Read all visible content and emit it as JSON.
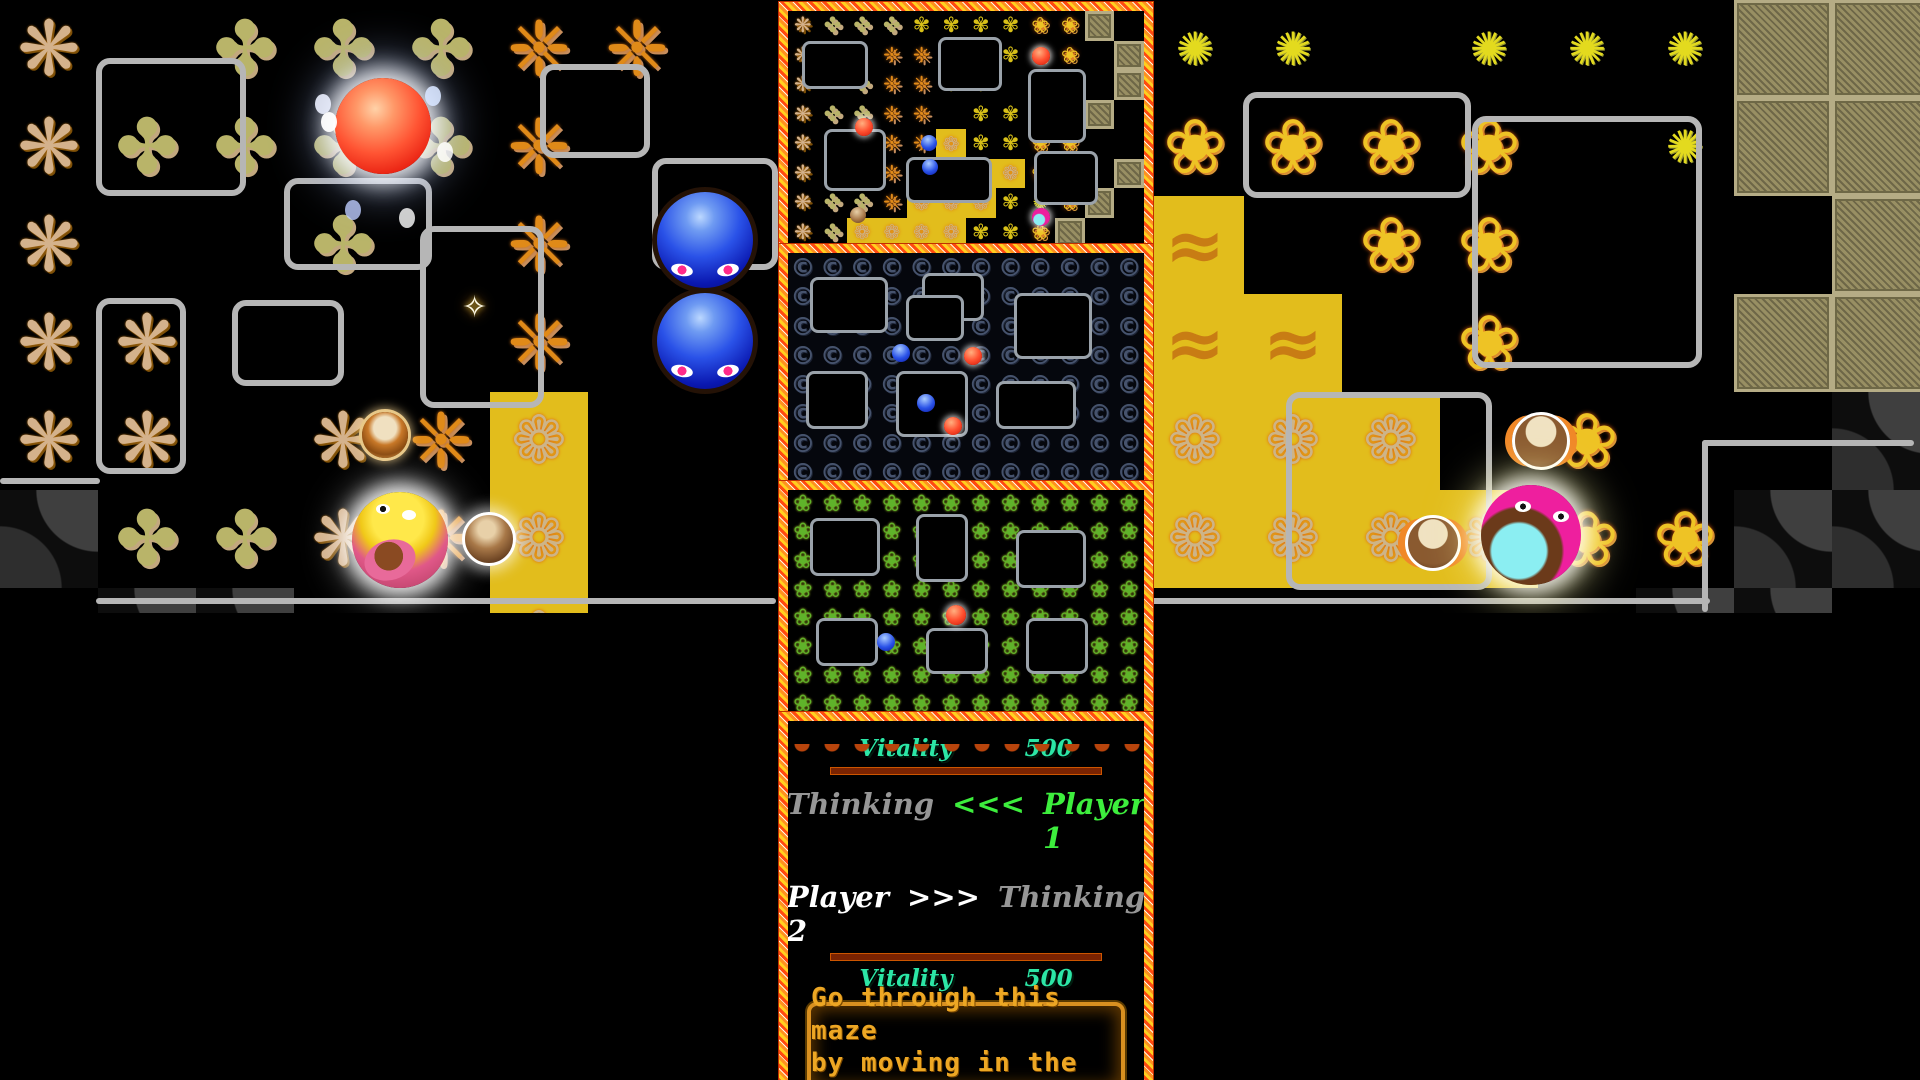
{
  "hud": {
    "player1": {
      "vitality_label": "Vitality",
      "vitality_value": "500",
      "vitality_percent": 50,
      "status_label": "Thinking",
      "arrows": "<<<",
      "name_label": "Player 1"
    },
    "player2": {
      "name_label": "Player 2",
      "arrows": ">>>",
      "status_label": "Thinking",
      "vitality_label": "Vitality",
      "vitality_value": "500",
      "vitality_percent": 50
    },
    "message_lines": [
      "Go through this maze",
      "by moving in the four"
    ],
    "colors": {
      "vitality_text": "#2ce6a6",
      "active_green": "#3dee3d",
      "idle_gray": "#969696",
      "p2_white": "#ffffff",
      "bar_fill_start": "#7ae22a",
      "bar_fill_end": "#e8a428",
      "bar_empty": "#8d7d5b",
      "bar_border": "#7a2301",
      "divider_cyan": "#18d2f4",
      "message_text": "#eda724",
      "wall_gray": "#b6b6b6"
    }
  },
  "tile_legend": {
    "star": {
      "glyph": "❋",
      "desc": "tan eight-point star tile"
    },
    "leaf": {
      "glyph": "✤",
      "desc": "olive leaf-cluster tile"
    },
    "ornate": {
      "glyph": "❈",
      "desc": "orange ornate snowflake tile"
    },
    "gold": {
      "glyph": "❁",
      "desc": "gold gear tile on yellow"
    },
    "swirl": {
      "glyph": "≈",
      "desc": "gold swirl tile on yellow"
    },
    "flower": {
      "glyph": "❀",
      "desc": "golden pentagon flower tile"
    },
    "pin": {
      "glyph": "✺",
      "desc": "small yellow pinwheel tile"
    },
    "golddot": {
      "glyph": "✾",
      "desc": "small gold flower tile"
    },
    "khaki": {
      "glyph": "",
      "desc": "khaki textured block"
    },
    "deco": {
      "glyph": "",
      "desc": "dark gray quarter-circle tile"
    },
    "ctile": {
      "glyph": "©",
      "desc": "dark blue C tile"
    },
    "clover": {
      "glyph": "❀",
      "desc": "green clover tile"
    },
    "blank": {
      "glyph": "",
      "desc": "empty"
    }
  },
  "minimaps": [
    {
      "name": "minimap-overview",
      "rows": [
        "slllddddffk.",
        "sl.oo.ddff.k",
        "s.loodd.ff.k",
        "slloo.ddffk.",
        "sl.oogddff..",
        "s.loogggff.k",
        "sllogggdpfk.",
        "slggggddfk.."
      ],
      "walls": [
        [
          14,
          30,
          66,
          48
        ],
        [
          150,
          26,
          64,
          54
        ],
        [
          240,
          58,
          58,
          74
        ],
        [
          36,
          118,
          62,
          62
        ],
        [
          118,
          146,
          86,
          46
        ],
        [
          246,
          140,
          64,
          54
        ]
      ],
      "dots": [
        [
          "red",
          253,
          45,
          18
        ],
        [
          "red",
          76,
          116,
          18
        ],
        [
          "blue",
          141,
          132,
          16
        ],
        [
          "blue",
          142,
          156,
          16
        ],
        [
          "brown",
          70,
          204,
          16
        ],
        [
          "pink",
          253,
          206,
          18
        ]
      ]
    },
    {
      "name": "minimap-dark-c",
      "rows": [
        "cccccccccccc",
        "cccccccccccc",
        "cccccccccccc",
        "cccccccccccc",
        "cccccccccccc",
        "cccccccccccc",
        "cccccccccccc",
        "cccccccccccc"
      ],
      "walls": [
        [
          22,
          24,
          78,
          56
        ],
        [
          134,
          20,
          62,
          48
        ],
        [
          226,
          40,
          78,
          66
        ],
        [
          18,
          118,
          62,
          58
        ],
        [
          108,
          118,
          72,
          66
        ],
        [
          208,
          128,
          80,
          48
        ],
        [
          118,
          42,
          58,
          46
        ]
      ],
      "dots": [
        [
          "blue",
          113,
          100,
          18
        ],
        [
          "red",
          185,
          103,
          18
        ],
        [
          "blue",
          138,
          150,
          18
        ],
        [
          "red",
          165,
          173,
          18
        ]
      ]
    },
    {
      "name": "minimap-clover",
      "rows": [
        "vvvvvvvvvvvv",
        "vvvvvvvvvvvv",
        "vvvvvvvvvvvv",
        "vvvvvvvvvvvv",
        "vvvvvvvvvvvv",
        "vvvvvvvvvvvv",
        "vvvvvvvvvvvv",
        "vvvvvvvvvvvv"
      ],
      "walls": [
        [
          22,
          28,
          70,
          58
        ],
        [
          128,
          24,
          52,
          68
        ],
        [
          228,
          40,
          70,
          58
        ],
        [
          28,
          128,
          62,
          48
        ],
        [
          138,
          138,
          62,
          46
        ],
        [
          238,
          128,
          62,
          56
        ]
      ],
      "dots": [
        [
          "red",
          168,
          125,
          20
        ],
        [
          "blue",
          98,
          152,
          18
        ]
      ]
    }
  ],
  "mazes": {
    "left": {
      "tiles": [
        [
          "star",
          0,
          0
        ],
        [
          "star",
          0,
          1
        ],
        [
          "star",
          0,
          2
        ],
        [
          "star",
          0,
          3
        ],
        [
          "star",
          0,
          4
        ],
        [
          "star",
          1,
          3
        ],
        [
          "star",
          1,
          4
        ],
        [
          "star",
          3,
          4
        ],
        [
          "star",
          3,
          5
        ],
        [
          "leaf",
          2,
          0
        ],
        [
          "leaf",
          3,
          0
        ],
        [
          "leaf",
          4,
          0
        ],
        [
          "leaf",
          1,
          1
        ],
        [
          "leaf",
          2,
          1
        ],
        [
          "leaf",
          3,
          1
        ],
        [
          "leaf",
          4,
          1
        ],
        [
          "leaf",
          3,
          2
        ],
        [
          "leaf",
          1,
          5
        ],
        [
          "leaf",
          2,
          5
        ],
        [
          "ornate",
          5,
          0
        ],
        [
          "ornate",
          6,
          0
        ],
        [
          "ornate",
          5,
          1
        ],
        [
          "ornate",
          5,
          2
        ],
        [
          "ornate",
          5,
          3
        ],
        [
          "ornate",
          4,
          4
        ],
        [
          "ornate",
          4,
          5
        ],
        [
          "gold",
          5,
          4
        ],
        [
          "gold",
          5,
          5
        ],
        [
          "gold",
          5,
          6
        ],
        [
          "deco",
          0,
          5
        ],
        [
          "deco",
          1,
          6
        ],
        [
          "deco",
          2,
          6
        ]
      ],
      "walls": [
        [
          96,
          58,
          150,
          138
        ],
        [
          284,
          178,
          148,
          92
        ],
        [
          96,
          298,
          90,
          176
        ],
        [
          232,
          300,
          112,
          86
        ],
        [
          420,
          226,
          124,
          182
        ],
        [
          540,
          64,
          110,
          94
        ],
        [
          652,
          158,
          126,
          112
        ],
        [
          96,
          598,
          680,
          6
        ],
        [
          0,
          478,
          100,
          6
        ]
      ],
      "entities": [
        [
          "red-player",
          335,
          78,
          96
        ],
        [
          "wand",
          462,
          290,
          30
        ],
        [
          "blue-ball",
          652,
          187,
          96
        ],
        [
          "blue-ball",
          652,
          288,
          96
        ],
        [
          "ring-creature",
          362,
          412,
          46
        ],
        [
          "yellow-player",
          352,
          492,
          96
        ],
        [
          "brown-orb",
          462,
          512,
          48
        ]
      ]
    },
    "right": {
      "tiles": [
        [
          "pin",
          0,
          0
        ],
        [
          "pin",
          1,
          0
        ],
        [
          "pin",
          3,
          0
        ],
        [
          "pin",
          4,
          0
        ],
        [
          "pin",
          5,
          0
        ],
        [
          "pin",
          5,
          1
        ],
        [
          "khaki",
          6,
          0
        ],
        [
          "khaki",
          7,
          0
        ],
        [
          "khaki",
          6,
          1
        ],
        [
          "khaki",
          7,
          1
        ],
        [
          "khaki",
          7,
          2
        ],
        [
          "khaki",
          6,
          3
        ],
        [
          "khaki",
          7,
          3
        ],
        [
          "flower",
          0,
          1
        ],
        [
          "flower",
          1,
          1
        ],
        [
          "flower",
          2,
          1
        ],
        [
          "flower",
          3,
          1
        ],
        [
          "flower",
          2,
          2
        ],
        [
          "flower",
          3,
          2
        ],
        [
          "flower",
          3,
          3
        ],
        [
          "flower",
          4,
          4
        ],
        [
          "flower",
          4,
          5
        ],
        [
          "flower",
          5,
          5
        ],
        [
          "flower",
          6,
          5
        ],
        [
          "swirl",
          0,
          2
        ],
        [
          "swirl",
          0,
          3
        ],
        [
          "swirl",
          1,
          3
        ],
        [
          "gold",
          0,
          4
        ],
        [
          "gold",
          1,
          4
        ],
        [
          "gold",
          2,
          4
        ],
        [
          "gold",
          0,
          5
        ],
        [
          "gold",
          1,
          5
        ],
        [
          "gold",
          2,
          5
        ],
        [
          "gold",
          3,
          5
        ],
        [
          "deco",
          7,
          4
        ],
        [
          "deco",
          6,
          5
        ],
        [
          "deco",
          7,
          5
        ],
        [
          "deco",
          5,
          6
        ],
        [
          "deco",
          6,
          6
        ]
      ],
      "walls": [
        [
          97,
          92,
          228,
          106
        ],
        [
          326,
          116,
          230,
          252
        ],
        [
          140,
          392,
          206,
          198
        ],
        [
          2,
          55,
          6,
          540
        ],
        [
          4,
          598,
          560,
          6
        ],
        [
          556,
          440,
          212,
          6
        ],
        [
          556,
          440,
          6,
          172
        ]
      ],
      "entities": [
        [
          "clock-creature",
          366,
          412,
          52
        ],
        [
          "clock-creature",
          259,
          515,
          50
        ],
        [
          "pink-player",
          335,
          485,
          100
        ]
      ]
    }
  }
}
